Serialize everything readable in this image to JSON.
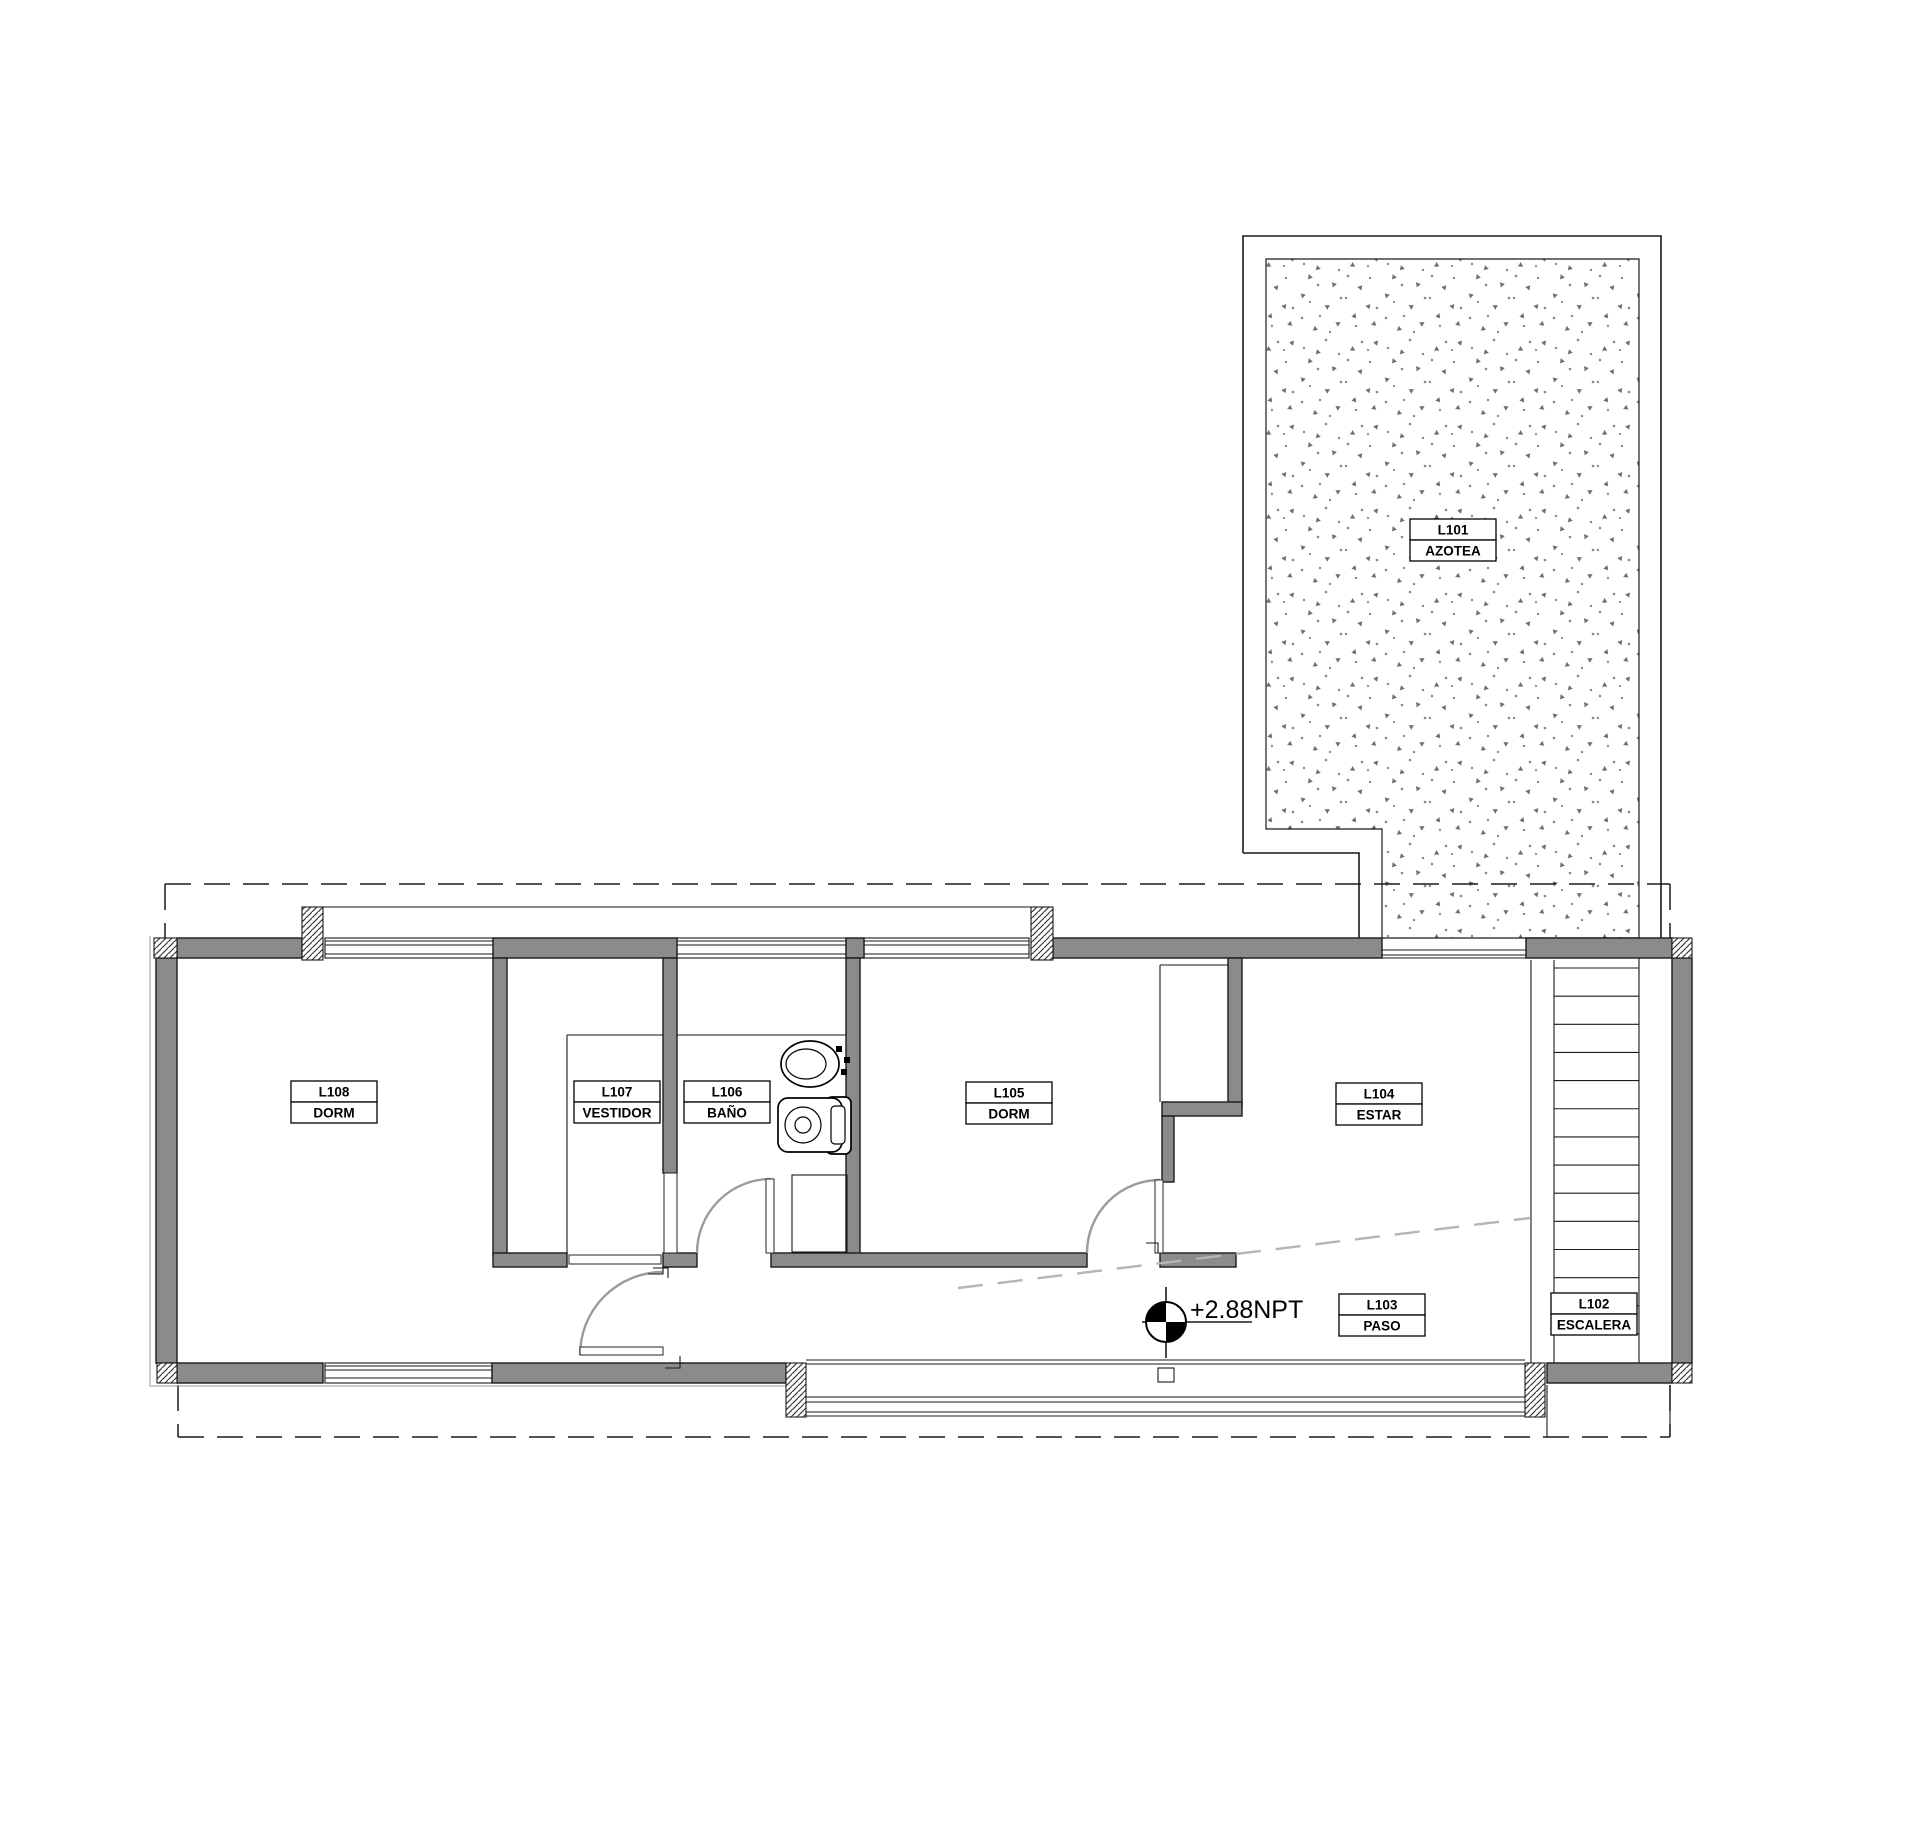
{
  "drawing": {
    "type": "architectural-floor-plan",
    "rooms": [
      {
        "code": "L101",
        "name": "AZOTEA"
      },
      {
        "code": "L102",
        "name": "ESCALERA"
      },
      {
        "code": "L103",
        "name": "PASO"
      },
      {
        "code": "L104",
        "name": "ESTAR"
      },
      {
        "code": "L105",
        "name": "DORM"
      },
      {
        "code": "L106",
        "name": "BAÑO"
      },
      {
        "code": "L107",
        "name": "VESTIDOR"
      },
      {
        "code": "L108",
        "name": "DORM"
      }
    ],
    "level_marker": {
      "label": "+2.88NPT"
    },
    "colors": {
      "paper": "#ffffff",
      "wall": "#8b8b8b",
      "line": "#1a1a1a",
      "door_arc": "#9b9b9b",
      "gray_dash": "#b5b5b5",
      "stipple_dark": "#6f6f6f",
      "stipple_light": "#8a8a8a"
    }
  }
}
